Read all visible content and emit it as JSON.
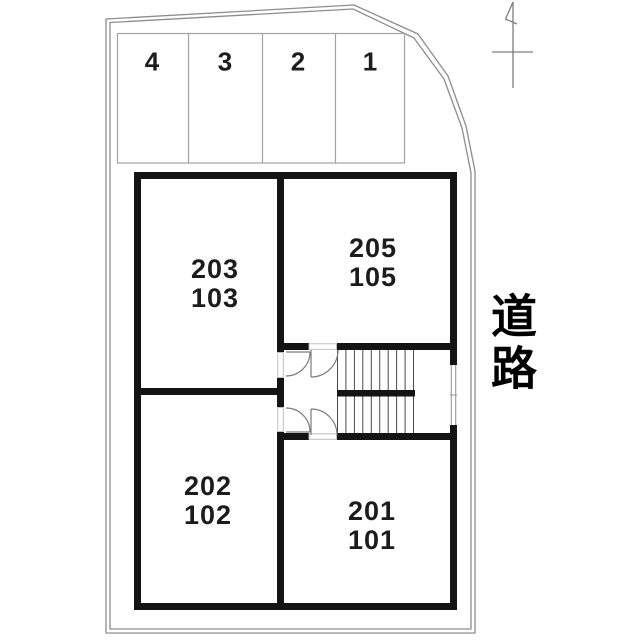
{
  "road": {
    "label": "道路"
  },
  "parking": {
    "stalls": [
      {
        "label": "4"
      },
      {
        "label": "3"
      },
      {
        "label": "2"
      },
      {
        "label": "1"
      }
    ]
  },
  "rooms": [
    {
      "upper": "203",
      "lower": "103"
    },
    {
      "upper": "205",
      "lower": "105"
    },
    {
      "upper": "202",
      "lower": "102"
    },
    {
      "upper": "201",
      "lower": "101"
    }
  ],
  "icons": {
    "north_arrow": "north-arrow-icon"
  },
  "colors": {
    "wall": "#141414",
    "ink": "#1c1c1c",
    "boundary": "#8d8d8d",
    "thin": "#a2a2a2",
    "tread": "#4a4a4a",
    "door": "#7a7a7a",
    "bg": "#ffffff"
  }
}
